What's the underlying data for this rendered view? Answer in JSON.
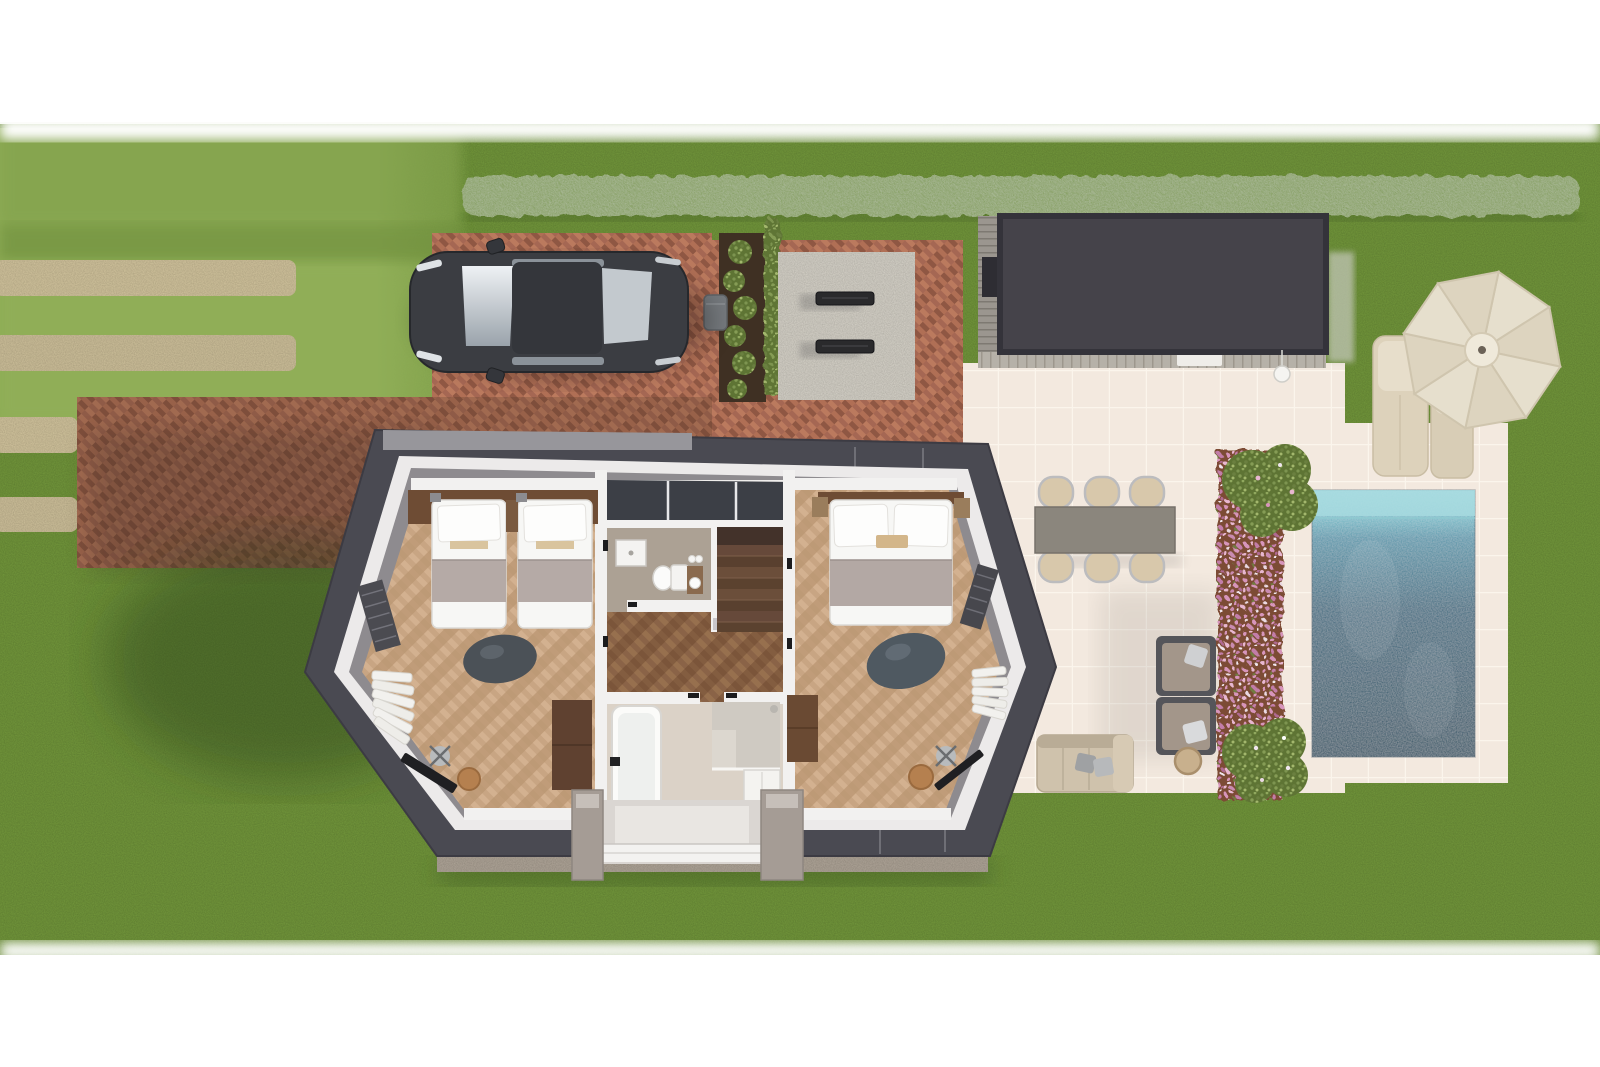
{
  "scene": {
    "title": "Top-down 3D floor plan of a holiday home with garden, driveway, garage, terrace and swimming pool",
    "labels": {
      "lawn": "garden lawn",
      "stepping_stones": "stepping stone path",
      "hedge": "trimmed hedge",
      "driveway": "brick herringbone driveway",
      "car": "parked car top view",
      "planter": "fern planter",
      "waste_bin": "waste bin",
      "bbq_pad": "concrete utility pad with grates",
      "garage": "flat-roof garden house",
      "outdoor_lamp": "white ball lamp",
      "patio": "tiled terrace",
      "dining_set": "outdoor dining table with six chairs",
      "lounge_chairs": "two lounge armchairs",
      "side_table": "round side table",
      "garden_sofa": "outdoor sofa",
      "flower_bed": "pink flower border",
      "bush": "flowering shrub",
      "pool": "swimming pool",
      "parasol": "parasol umbrella",
      "sun_loungers": "two sun loungers",
      "house": "cutaway upper floor of house",
      "left_bedroom": "bedroom with two single beds",
      "right_bedroom": "bedroom with double bed",
      "toilet_room": "toilet room",
      "staircase": "staircase",
      "hallway": "landing hallway",
      "bathroom": "bathroom with bathtub and shower",
      "entrance": "entrance porch",
      "solar_panels": "roof windows above landing",
      "gravel": "gravel drip edge"
    },
    "palette": {
      "canvas": "#ffffff",
      "grass": "#73983e",
      "grass_light": "#8dac55",
      "grass_shadow": "#233813",
      "hedge": "#7e9a52",
      "brick": "#a8674f",
      "stepping_stone": "#d3c59e",
      "patio_tile": "#f3e9df",
      "pool_shallow": "#93d4da",
      "pool_deep": "#1d4a5e",
      "soil": "#7c4b34",
      "flower_pink": "#d795bb",
      "roof": "#4a4a52",
      "roof_ridge": "#97969b",
      "wall_white": "#eceaea",
      "wall_inner": "#8e8b8f",
      "floor_oak": "#c8a583",
      "floor_walnut": "#8a6347",
      "garage_roof": "#45434a",
      "decking": "#b6b1a8",
      "car_body": "#3b3d42",
      "cream_fabric": "#ddd2bb",
      "stair_wood": "#5f4534"
    },
    "counts": {
      "single_beds": 2,
      "double_beds": 1,
      "dining_chairs": 6,
      "lounge_chairs": 2,
      "sun_loungers": 2,
      "rooms_visible": 6
    }
  }
}
